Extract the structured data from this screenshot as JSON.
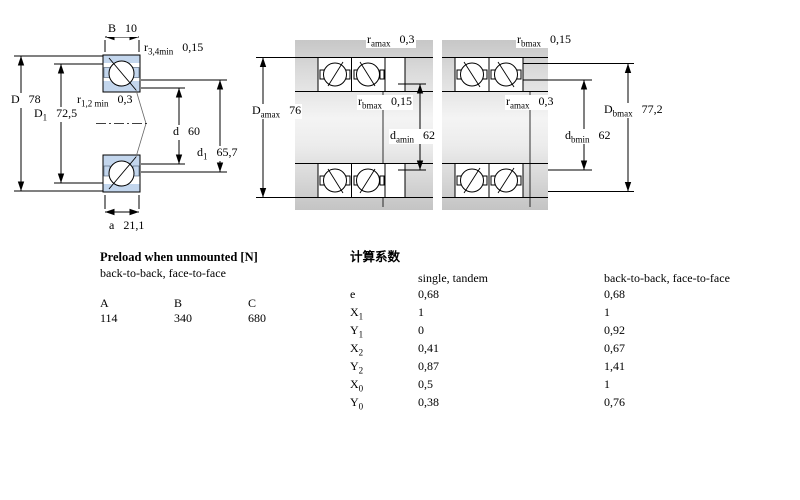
{
  "drawings": {
    "left": {
      "b": {
        "sym": "B",
        "sub": "",
        "val": "10"
      },
      "r34": {
        "sym": "r",
        "sub": "3,4min",
        "val": "0,15"
      },
      "r12": {
        "sym": "r",
        "sub": "1,2 min",
        "val": "0,3"
      },
      "D": {
        "sym": "D",
        "sub": "",
        "val": "78"
      },
      "D1": {
        "sym": "D",
        "sub": "1",
        "val": "72,5"
      },
      "d": {
        "sym": "d",
        "sub": "",
        "val": "60"
      },
      "d1": {
        "sym": "d",
        "sub": "1",
        "val": "65,7"
      },
      "a": {
        "sym": "a",
        "sub": "",
        "val": "21,1"
      }
    },
    "middle": {
      "ramax": {
        "sym": "r",
        "sub": "amax",
        "val": "0,3"
      },
      "rbmax": {
        "sym": "r",
        "sub": "bmax",
        "val": "0,15"
      },
      "Damax": {
        "sym": "D",
        "sub": "amax",
        "val": "76"
      },
      "damin": {
        "sym": "d",
        "sub": "amin",
        "val": "62"
      }
    },
    "right": {
      "rbmax": {
        "sym": "r",
        "sub": "bmax",
        "val": "0,15"
      },
      "ramax": {
        "sym": "r",
        "sub": "amax",
        "val": "0,3"
      },
      "Dbmax": {
        "sym": "D",
        "sub": "bmax",
        "val": "77,2"
      },
      "dbmin": {
        "sym": "d",
        "sub": "bmin",
        "val": "62"
      }
    }
  },
  "preload": {
    "title": "Preload when unmounted [N]",
    "subtitle": "back-to-back, face-to-face",
    "columns": [
      "A",
      "B",
      "C"
    ],
    "values": [
      "114",
      "340",
      "680"
    ]
  },
  "factors": {
    "title": "计算系数",
    "col1_header": "single, tandem",
    "col2_header": "back-to-back, face-to-face",
    "rows": [
      {
        "sym": "e",
        "sub": "",
        "v1": "0,68",
        "v2": "0,68"
      },
      {
        "sym": "X",
        "sub": "1",
        "v1": "1",
        "v2": "1"
      },
      {
        "sym": "Y",
        "sub": "1",
        "v1": "0",
        "v2": "0,92"
      },
      {
        "sym": "X",
        "sub": "2",
        "v1": "0,41",
        "v2": "0,67"
      },
      {
        "sym": "Y",
        "sub": "2",
        "v1": "0,87",
        "v2": "1,41"
      },
      {
        "sym": "X",
        "sub": "0",
        "v1": "0,5",
        "v2": "1"
      },
      {
        "sym": "Y",
        "sub": "0",
        "v1": "0,38",
        "v2": "0,76"
      }
    ]
  },
  "colors": {
    "ring_blue": "#c3d6ed",
    "steel_gray": "#d0d0d0"
  }
}
